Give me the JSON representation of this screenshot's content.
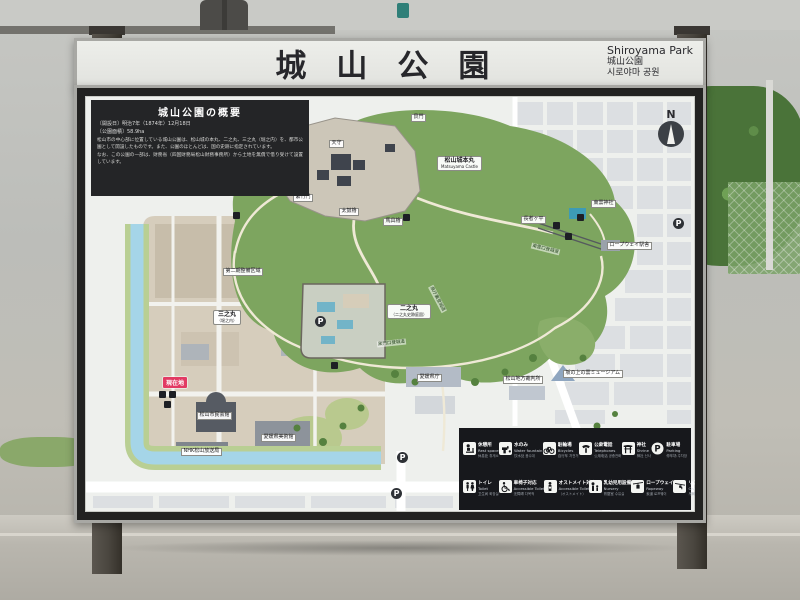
{
  "title_board": {
    "ja": "城山公園",
    "en": "Shiroyama Park",
    "ja_sub": "城山公園",
    "ko": "시로야마 공원"
  },
  "overview": {
    "title": "城山公園の概要",
    "line1": "〔開設日〕明治7年（1874年）12月18日",
    "line2": "〔公園面積〕58.9ha",
    "body1": "松山市の中心部に位置している城山公園は、松山城の本丸、二之丸、三之丸（堀之内）を、都市公園として開設したものです。また、公園のほとんどは、国の史跡に指定されています。",
    "body2": "なお、この公園の一部は、財務省（四国財務局松山財務事務所）から土地を無償で借り受けて設置しています。"
  },
  "compass": {
    "label": "N"
  },
  "map": {
    "labels": {
      "castle_ja": "松山城本丸",
      "castle_en": "Matsuyama Castle",
      "ninomaru_ja": "二之丸",
      "ninomaru_sub": "（二之丸史跡庭園）",
      "sannomaru_ja": "三之丸",
      "sannomaru_sub": "（堀之内）",
      "shrine": "東雲神社",
      "ropeway_station": "ロープウェイ駅舎",
      "chojagahira": "長者ヶ平",
      "museum": "坂の上の雲ミュージアム",
      "pref_office": "愛媛県庁",
      "court": "松山地方裁判所",
      "art_museum": "愛媛県美術館",
      "nhk": "NHK松山放送局",
      "civic_hall": "松山市民会館",
      "phase2": "第二期整備区域",
      "tenshu": "天守",
      "inui": "乾門",
      "nohara": "野原櫓",
      "shichiku": "紫竹門",
      "taiko": "太鼓櫓",
      "bagu": "馬具櫓",
      "ushitora": "艮門",
      "route_furumachi": "古町口登城道",
      "route_kuromon": "黒門口登城道",
      "route_kencho": "県庁裏登城道",
      "route_shinonome": "東雲口登城道",
      "parking": "P",
      "you_are_here": "現在地"
    },
    "legend": {
      "row1": [
        {
          "ja": "休憩所",
          "en": "Rest space",
          "sub": "休息处 휴게소"
        },
        {
          "ja": "水のみ",
          "en": "Water fountain",
          "sub": "饮水处 음수대"
        },
        {
          "ja": "駐輪場",
          "en": "Bicycles",
          "sub": "自行车 자전거"
        },
        {
          "ja": "公衆電話",
          "en": "Telephones",
          "sub": "公用电话 공중전화"
        },
        {
          "ja": "神社",
          "en": "Shrine",
          "sub": "神社 신사"
        },
        {
          "ja": "駐車場",
          "en": "Parking",
          "sub": "停车场 주차장"
        }
      ],
      "row2": [
        {
          "ja": "トイレ",
          "en": "Toilet",
          "sub": "卫生间 화장실"
        },
        {
          "ja": "車椅子対応",
          "en": "Accessible Toilet",
          "sub": "无障碍 다목적"
        },
        {
          "ja": "オストメイト対応",
          "en": "Accessible Toilet",
          "sub": "（オストメイト）"
        },
        {
          "ja": "乳幼児用設備",
          "en": "Nursery",
          "sub": "育婴室 수유실"
        },
        {
          "ja": "ロープウェイ",
          "en": "Ropeway",
          "sub": "索道 로프웨이"
        },
        {
          "ja": "リフト",
          "en": "Chair Lift",
          "sub": "吊椅 리프트"
        }
      ],
      "you_are_here": {
        "badge": "現在地",
        "ja": "現在地",
        "en": "You are Here"
      }
    }
  }
}
